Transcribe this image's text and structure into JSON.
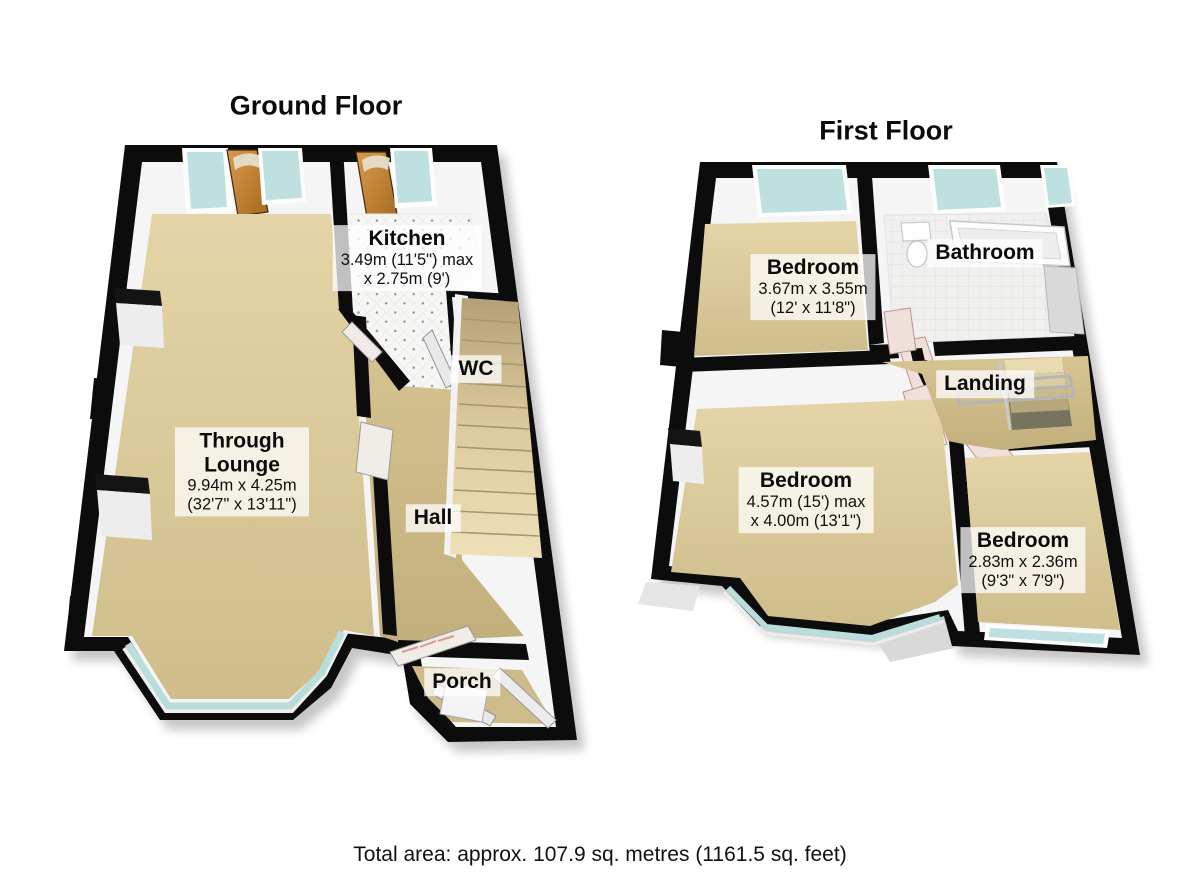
{
  "ground_floor": {
    "title": "Ground Floor",
    "rooms": {
      "kitchen": {
        "name": "Kitchen",
        "dim1": "3.49m (11'5\") max",
        "dim2": "x 2.75m (9')"
      },
      "wc": {
        "name": "WC"
      },
      "through_lounge": {
        "name": "Through Lounge",
        "dim1": "9.94m x 4.25m",
        "dim2": "(32'7\" x 13'11\")"
      },
      "hall": {
        "name": "Hall"
      },
      "porch": {
        "name": "Porch"
      }
    }
  },
  "first_floor": {
    "title": "First Floor",
    "rooms": {
      "bedroom_front": {
        "name": "Bedroom",
        "dim1": "3.67m x 3.55m",
        "dim2": "(12' x 11'8\")"
      },
      "bathroom": {
        "name": "Bathroom"
      },
      "landing": {
        "name": "Landing"
      },
      "bedroom_main": {
        "name": "Bedroom",
        "dim1": "4.57m (15') max",
        "dim2": "x 4.00m (13'1\")"
      },
      "bedroom_rear": {
        "name": "Bedroom",
        "dim1": "2.83m x 2.36m",
        "dim2": "(9'3\" x 7'9\")"
      }
    }
  },
  "footer": {
    "total_area": "Total area: approx. 107.9 sq. metres (1161.5 sq. feet)"
  },
  "colors": {
    "wall": "#0c0c0c",
    "inner_wall": "#f5f5f5",
    "floor_tan": "#d8c79a",
    "floor_hall": "#cdbb87",
    "glass": "#bfe0e0",
    "door_wood": "#c07b33",
    "door_white": "#efe0dc",
    "stairs": "#e9dcb2",
    "label_background": "rgba(255,255,255,0.74)"
  }
}
